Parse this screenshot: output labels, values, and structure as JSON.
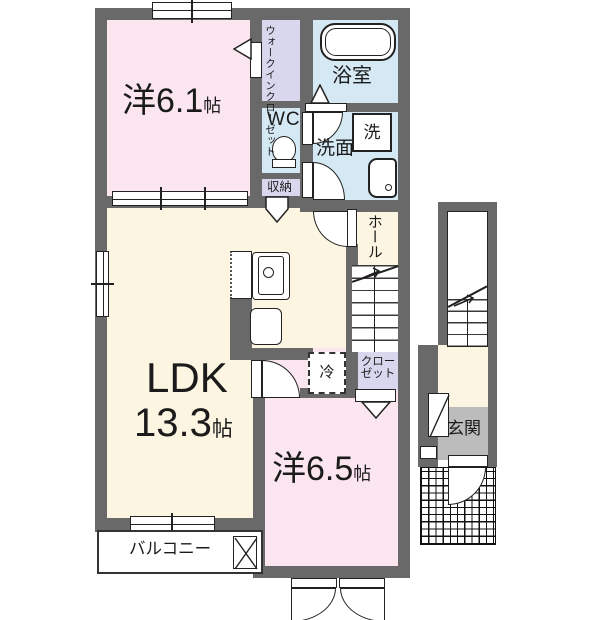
{
  "title": "apartment-floor-plan",
  "rooms": {
    "western1": {
      "name": "洋6.1",
      "unit": "帖"
    },
    "wic": {
      "l1": "ウォークイン",
      "l2": "クローゼット"
    },
    "wc": "WC",
    "storage": "収納",
    "bath": "浴室",
    "washroom": "洗面",
    "washer": "洗",
    "hall": "ホール",
    "ldk": {
      "name": "LDK",
      "size": "13.3",
      "unit": "帖"
    },
    "fridge": "冷",
    "closet": {
      "l1": "クロー",
      "l2": "ゼット"
    },
    "western2": {
      "name": "洋6.5",
      "unit": "帖"
    },
    "balcony": "バルコニー",
    "entrance": "玄関"
  },
  "colors": {
    "wall": "#696969",
    "room_pink": "#fbe5ef",
    "room_cream": "#fcf5e1",
    "closet_lavender": "#d9d7ee",
    "wet_blue": "#d4e9f4",
    "entrance_gray": "#bcbcbc"
  }
}
